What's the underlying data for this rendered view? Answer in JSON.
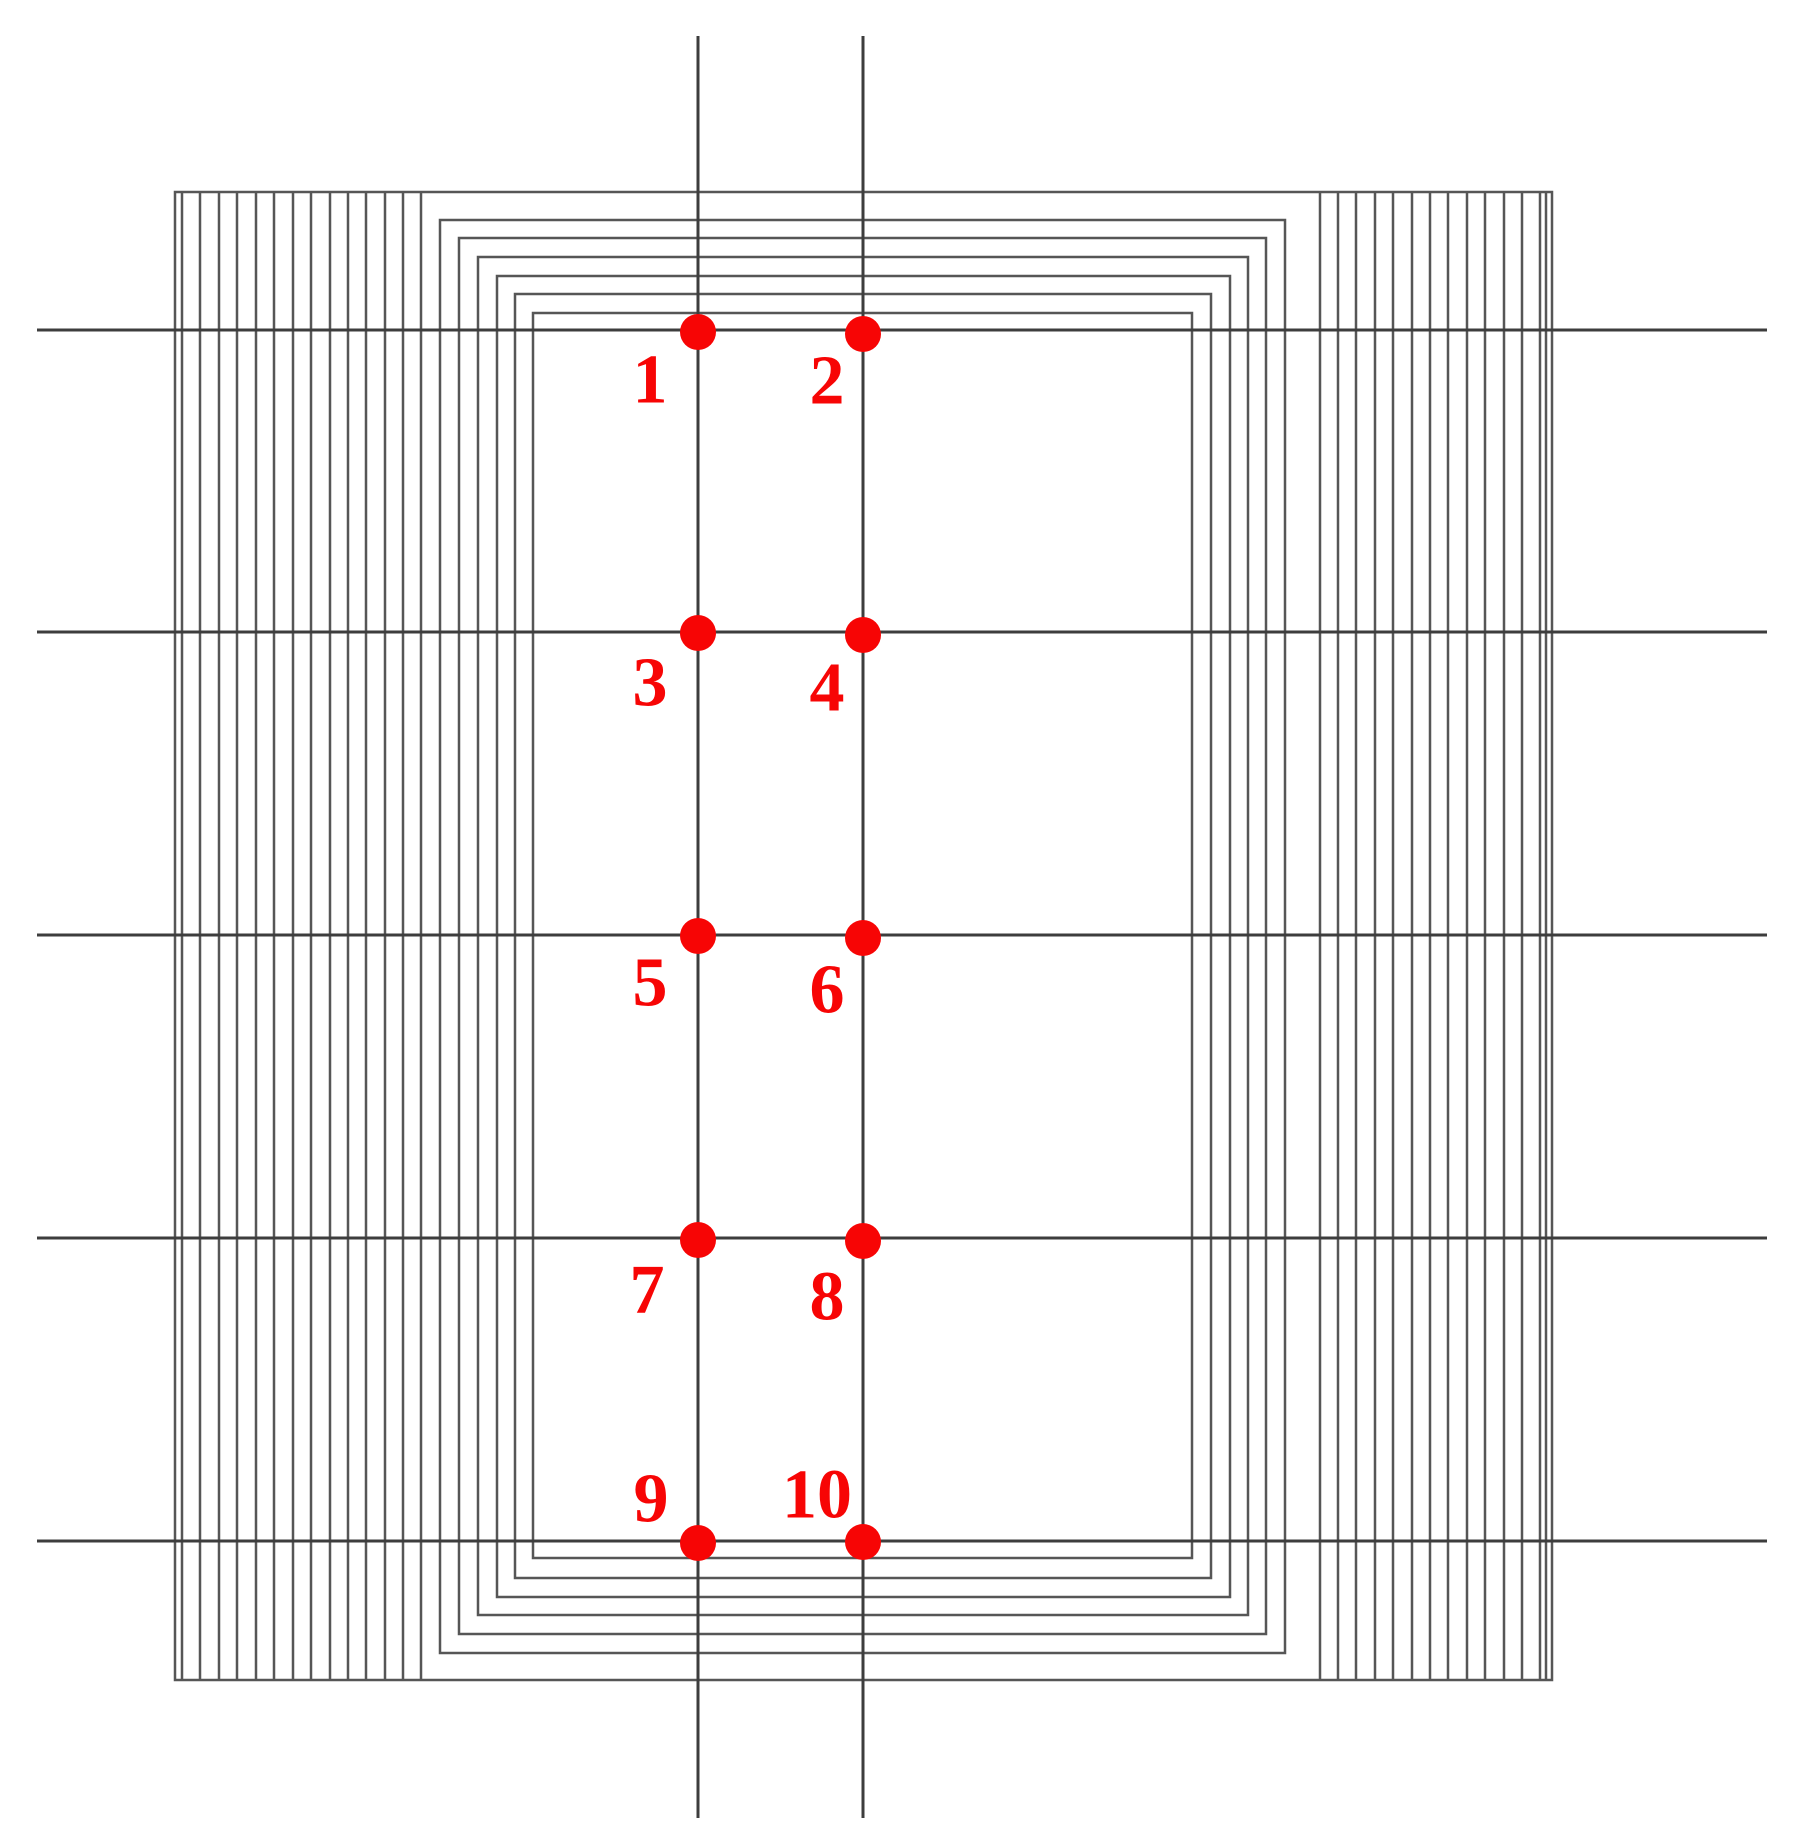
{
  "figure": {
    "description": "Coil winding diagram with measurement grid and ten numbered measurement points",
    "canvas": {
      "width": 1796,
      "height": 1846,
      "background": "#ffffff"
    },
    "colors": {
      "structure_line": "#565656",
      "grid_line": "#3d3d3d",
      "point_red": "#f70505"
    },
    "stroke_widths": {
      "structure": 2.5,
      "grid": 3
    },
    "outer_rect": {
      "x1": 175,
      "y1": 192,
      "x2": 1552,
      "y2": 1680
    },
    "left_band_x": [
      182,
      200,
      219,
      237,
      256,
      274,
      293,
      311,
      330,
      348,
      366,
      385,
      403,
      421
    ],
    "right_band_x": [
      1320,
      1338,
      1356,
      1375,
      1393,
      1412,
      1430,
      1448,
      1467,
      1485,
      1504,
      1522,
      1540,
      1546
    ],
    "nested_rects": [
      {
        "x1": 440,
        "y1": 220,
        "x2": 1285,
        "y2": 1653
      },
      {
        "x1": 459,
        "y1": 238,
        "x2": 1266,
        "y2": 1634
      },
      {
        "x1": 478,
        "y1": 257,
        "x2": 1248,
        "y2": 1615
      },
      {
        "x1": 497,
        "y1": 276,
        "x2": 1230,
        "y2": 1597
      },
      {
        "x1": 515,
        "y1": 294,
        "x2": 1211,
        "y2": 1578
      },
      {
        "x1": 533,
        "y1": 313,
        "x2": 1192,
        "y2": 1558
      }
    ],
    "grid": {
      "horizontal_y": [
        330,
        632,
        935,
        1238,
        1541
      ],
      "h_x1": 37,
      "h_x2": 1767,
      "vertical_x": [
        698,
        863
      ],
      "v_y1": 36,
      "v_y2": 1818
    },
    "dot_radius": 18,
    "label_font_size": 70,
    "points": [
      {
        "label": "1",
        "x": 698,
        "y": 332,
        "ldx": -48,
        "ldy": 48
      },
      {
        "label": "2",
        "x": 863,
        "y": 334,
        "ldx": -36,
        "ldy": 47
      },
      {
        "label": "3",
        "x": 698,
        "y": 633,
        "ldx": -48,
        "ldy": 50
      },
      {
        "label": "4",
        "x": 863,
        "y": 635,
        "ldx": -36,
        "ldy": 53
      },
      {
        "label": "5",
        "x": 698,
        "y": 936,
        "ldx": -48,
        "ldy": 47
      },
      {
        "label": "6",
        "x": 863,
        "y": 938,
        "ldx": -36,
        "ldy": 52
      },
      {
        "label": "7",
        "x": 698,
        "y": 1240,
        "ldx": -51,
        "ldy": 50
      },
      {
        "label": "8",
        "x": 863,
        "y": 1241,
        "ldx": -36,
        "ldy": 56
      },
      {
        "label": "9",
        "x": 698,
        "y": 1543,
        "ldx": -47,
        "ldy": -44
      },
      {
        "label": "10",
        "x": 863,
        "y": 1542,
        "ldx": -46,
        "ldy": -47
      }
    ]
  }
}
